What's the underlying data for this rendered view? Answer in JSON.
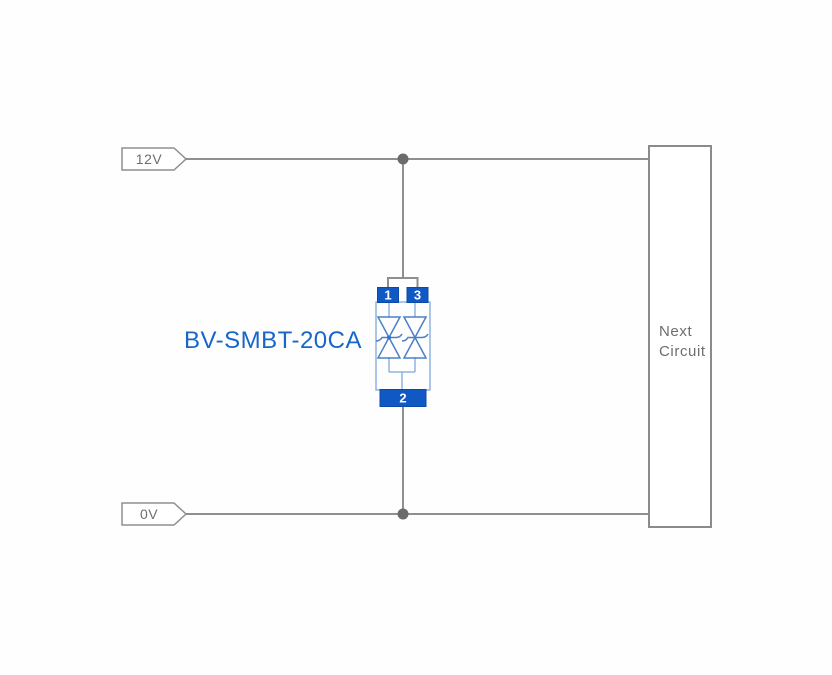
{
  "diagram_title": "BV-SMBT-20CA TVS diode application circuit",
  "rails": {
    "top": {
      "label": "12V"
    },
    "bottom": {
      "label": "0V"
    }
  },
  "component": {
    "label": "BV-SMBT-20CA",
    "pins": {
      "top_left": "1",
      "top_right": "3",
      "bottom": "2"
    }
  },
  "next_circuit": {
    "lines": [
      "Next",
      "Circuit"
    ]
  },
  "colors": {
    "wire_gray": "#8f8f8f",
    "junction_gray": "#6b6b6b",
    "flag_text_gray": "#6e6e6e",
    "box_border_gray": "#8a8a8a",
    "pin_blue": "#1058c4",
    "component_outline_blue": "#8fb3de",
    "diode_blue": "#4a80c8",
    "label_blue": "#1766ca"
  }
}
